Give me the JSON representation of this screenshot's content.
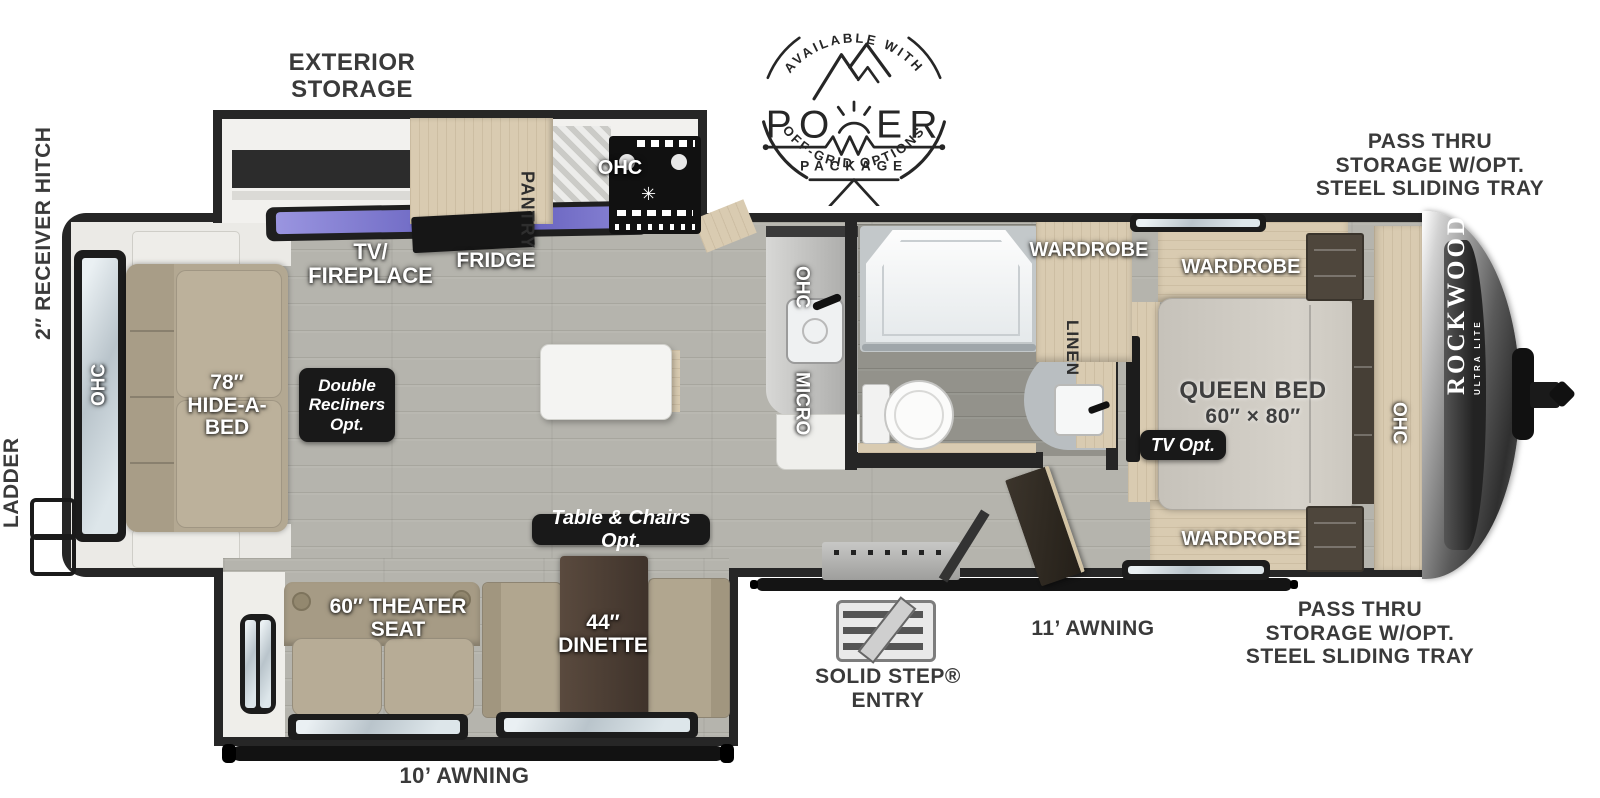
{
  "title": "Rockwood Ultra Lite Travel Trailer Floor Plan",
  "power_badge": {
    "available_with": "AVAILABLE WITH",
    "power_left": "PO",
    "power_right": "ER",
    "package": "PACKAGE",
    "off_grid": "OFF-GRID OPTIONS"
  },
  "exterior_labels": {
    "exterior_storage": [
      "EXTERIOR",
      "STORAGE"
    ],
    "pass_thru_front": [
      "PASS THRU",
      "STORAGE W/OPT.",
      "STEEL SLIDING TRAY"
    ],
    "pass_thru_rear": [
      "PASS THRU",
      "STORAGE W/OPT.",
      "STEEL SLIDING TRAY"
    ],
    "receiver_hitch": "2″ RECEIVER HITCH",
    "ladder": "LADDER",
    "awning_11": "11’ AWNING",
    "awning_10": "10’ AWNING",
    "solid_step": [
      "SOLID STEP®",
      "ENTRY"
    ]
  },
  "interior_labels": {
    "tv_fireplace": [
      "TV/",
      "FIREPLACE"
    ],
    "fridge": "FRIDGE",
    "pantry": "PANTRY",
    "ohc_stove": "OHC",
    "ohc_counter": "OHC",
    "micro": "MICRO",
    "ohc_rear": "OHC",
    "hide_a_bed": [
      "78″",
      "HIDE-A-",
      "BED"
    ],
    "wardrobe_bath": "WARDROBE",
    "linen": "LINEN",
    "wardrobe_top": "WARDROBE",
    "wardrobe_bottom": "WARDROBE",
    "queen_bed": [
      "QUEEN BED",
      "60″ × 80″"
    ],
    "ohc_bedroom": "OHC",
    "theater_seat": [
      "60″ THEATER",
      "SEAT"
    ],
    "dinette": [
      "44″",
      "DINETTE"
    ]
  },
  "option_badges": {
    "double_recliners": [
      "Double",
      "Recliners",
      "Opt."
    ],
    "table_chairs": "Table & Chairs Opt.",
    "tv_opt": "TV Opt."
  },
  "brand": {
    "name": "ROCKWOOD",
    "sub": "ULTRA LITE"
  },
  "colors": {
    "wall": "#262626",
    "floor": "#b5b4ad",
    "bath_floor": "#93928b",
    "cabinet_tan": "#d9cbb1",
    "sofa": "#b3a892",
    "tv_screen": "#7d78c8",
    "badge_black": "#191919"
  }
}
